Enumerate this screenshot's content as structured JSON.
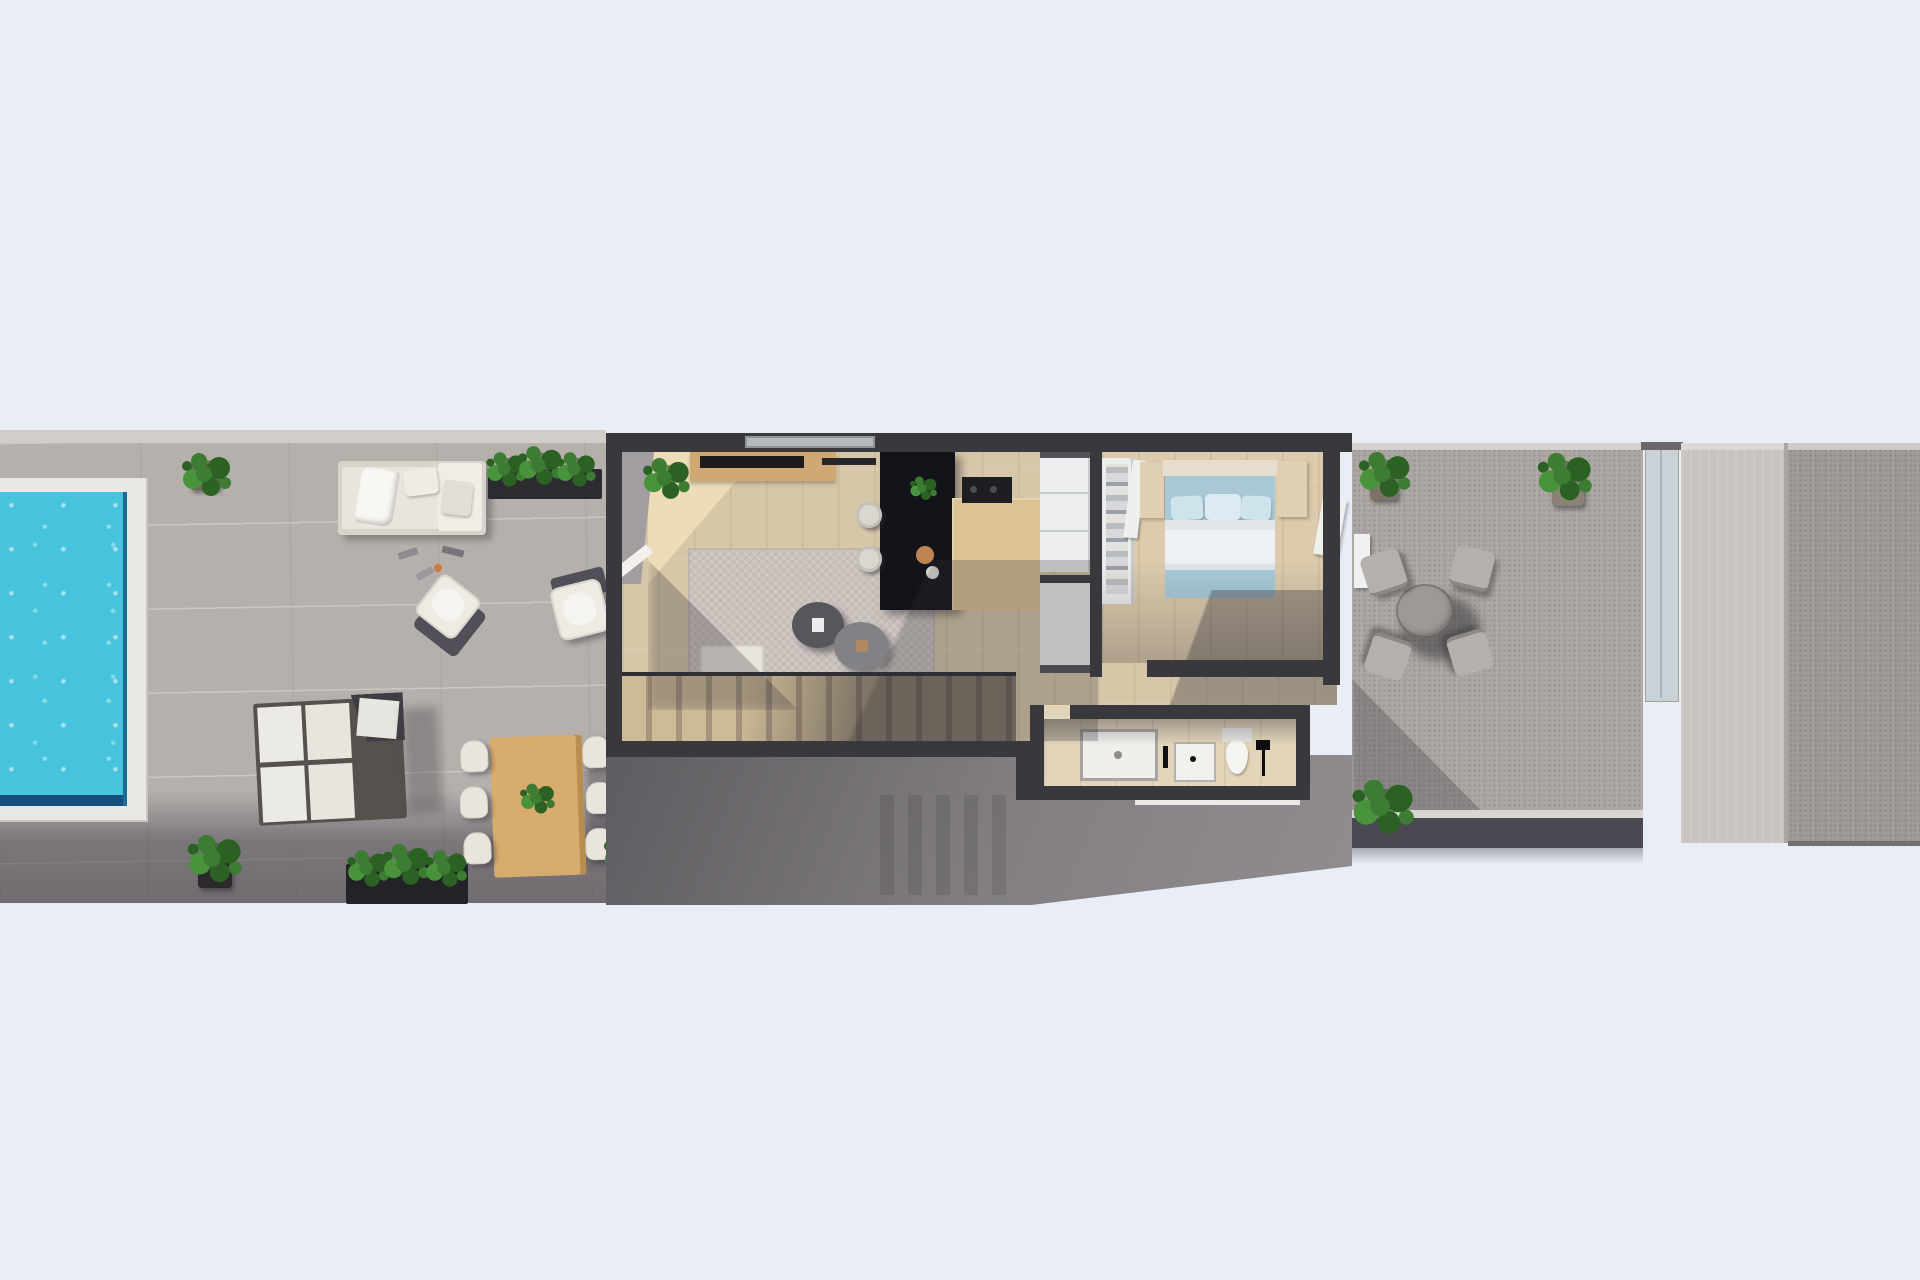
{
  "scene": {
    "title": "Top-down 3D floor plan render",
    "style": "Photorealistic architectural visualization, bird's-eye view",
    "description": "Single storey of a narrow row house: pool terrace with outdoor lounge and dining on the left, open living room and kitchen in the centre, bedroom with en-suite bathroom and a rear terrace with bistro set on the right, staircase casting a long diagonal shadow below"
  },
  "palette": {
    "bg": "#e9edf6",
    "wall": "#39383d",
    "wallDark": "#2c2b30",
    "floor": "#d7c7a9",
    "floorSun": "#ecdcb8",
    "floorBath": "#e2d5ba",
    "floorBedroom": "#dccbac",
    "terrace": "#b6b0ad",
    "terraceBand": "#d2cdc9",
    "terraceRight": "#aba6a2",
    "concrete": "#c8c4bf",
    "neighbour": "#9e9995",
    "patio": "#908c8f",
    "poolWater": "#46c3dd",
    "poolDeep": "#15507c",
    "poolEdge": "#1d6a95",
    "coping": "#eae8e4",
    "cream": "#e9e5dd",
    "creamDark": "#d8d4cb",
    "wood": "#d8ac6c",
    "woodLight": "#dcc394",
    "woodConsole": "#cfa874",
    "island": "#13141a",
    "rug": "#c9c1bc",
    "stairTread": "#cdbb97",
    "stairGap": "#a5937a",
    "bedBlue": "#a9c9d6",
    "bedThrow": "#a8cad8",
    "duvet": "#eef1f3",
    "white": "#f1efec",
    "glass": "#c9d2d6",
    "leafDark": "#2c6124",
    "leaf": "#3d7c33",
    "leafLight": "#49933c",
    "shadow": "rgba(45,43,52,0.42)",
    "accentTan": "#b08a5e",
    "accentOrange": "#c97a3e"
  },
  "areas": {
    "pool": {
      "label": "Swimming pool"
    },
    "pool_terrace": {
      "label": "Pool terrace"
    },
    "living": {
      "label": "Living room"
    },
    "kitchen": {
      "label": "Kitchen"
    },
    "hallway": {
      "label": "Hallway"
    },
    "bedroom": {
      "label": "Bedroom"
    },
    "bathroom": {
      "label": "Bathroom"
    },
    "stairs": {
      "label": "Staircase"
    },
    "terrace": {
      "label": "Rear terrace"
    },
    "passage": {
      "label": "Side passage"
    },
    "neighbour": {
      "label": "Neighbouring terrace"
    },
    "patio": {
      "label": "Lower patio in shadow"
    }
  },
  "furniture": {
    "plant_front": {
      "label": "Potted plant"
    },
    "outdoor_sofa": {
      "label": "Outdoor lounge sofa with white throw"
    },
    "hedge_top": {
      "label": "Hedge planter"
    },
    "armchair_a": {
      "label": "Outdoor armchair"
    },
    "armchair_b": {
      "label": "Outdoor armchair"
    },
    "scatter": {
      "label": "Poolside accessories"
    },
    "sun_loungers": {
      "label": "Double sun loungers"
    },
    "dining_set": {
      "label": "Outdoor dining table with six chairs"
    },
    "planter_a": {
      "label": "Potted plant"
    },
    "planter_hedge": {
      "label": "Hedge planter box"
    },
    "planter_b": {
      "label": "Potted plant"
    },
    "entry_plant": {
      "label": "Indoor plant at entrance"
    },
    "tv_console": {
      "label": "TV sideboard"
    },
    "tv": {
      "label": "Wall-mounted TV"
    },
    "soundbar": {
      "label": "Soundbar"
    },
    "rug": {
      "label": "Area rug"
    },
    "coffee_table_a": {
      "label": "Round coffee table"
    },
    "coffee_table_b": {
      "label": "Round coffee table"
    },
    "sofa": {
      "label": "Corner sofa with cushions"
    },
    "side_table": {
      "label": "Round side table"
    },
    "island": {
      "label": "Dark kitchen island"
    },
    "counter": {
      "label": "Kitchen counter with cooktop"
    },
    "stools": {
      "label": "Bar stools"
    },
    "pendants": {
      "label": "Pendant lights"
    },
    "tall_units": {
      "label": "Tall kitchen units"
    },
    "hall_cabinet": {
      "label": "Hallway cabinet"
    },
    "wardrobe": {
      "label": "Open wardrobe with clothes"
    },
    "nightstand_left": {
      "label": "Bedside cabinet"
    },
    "nightstand_right": {
      "label": "Bedside cabinet"
    },
    "bed": {
      "label": "Double bed with blue bedding"
    },
    "terrace_door": {
      "label": "Open terrace door"
    },
    "shower": {
      "label": "Walk-in shower"
    },
    "vanity": {
      "label": "Washbasin"
    },
    "toilet": {
      "label": "Toilet"
    },
    "bath_lamp": {
      "label": "Black floor lamp"
    },
    "staircase": {
      "label": "Staircase to lower floor"
    },
    "terrace_plant_a": {
      "label": "Potted plant"
    },
    "terrace_plant_b": {
      "label": "Potted plant"
    },
    "terrace_plant_c": {
      "label": "Potted plant"
    },
    "wall_panel": {
      "label": "White wall panel"
    },
    "bistro_set": {
      "label": "Round bistro table with four chairs"
    },
    "privacy_screen": {
      "label": "Glass privacy screen"
    }
  }
}
